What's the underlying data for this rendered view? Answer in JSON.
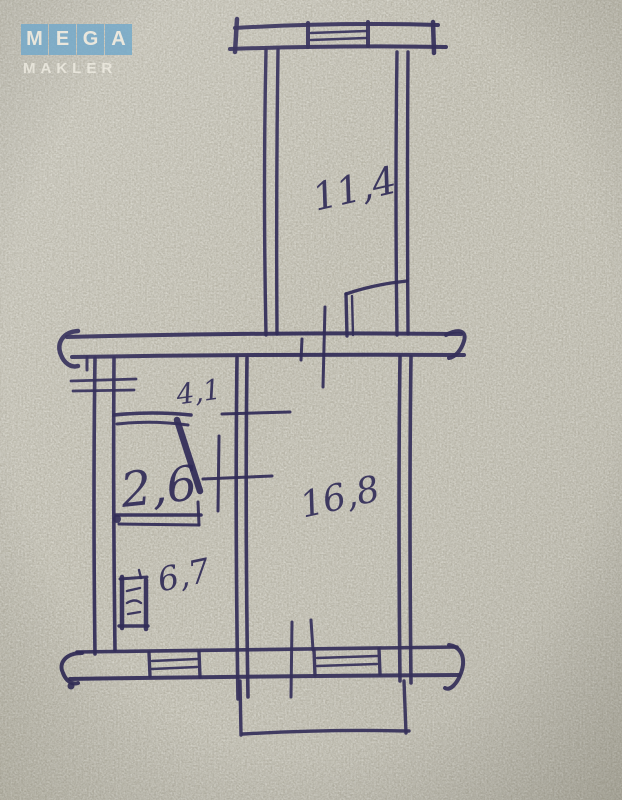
{
  "colors": {
    "paper": "#b8b5a7",
    "ink": "#302b57",
    "logo_tile": "#72a9cb",
    "logo_text": "#f2efe5"
  },
  "logo": {
    "brand_word": "MEGA",
    "brand_letters": [
      "M",
      "E",
      "G",
      "A"
    ],
    "brand_sub": "MAKLER"
  },
  "sketch": {
    "rooms": {
      "loggia": {
        "area_label": "11,4"
      },
      "hallway": {
        "area_label": "4,1"
      },
      "bathroom": {
        "area_label": "2,6"
      },
      "living_room": {
        "area_label": "16,8"
      },
      "kitchen": {
        "area_label": "6,7"
      }
    }
  }
}
